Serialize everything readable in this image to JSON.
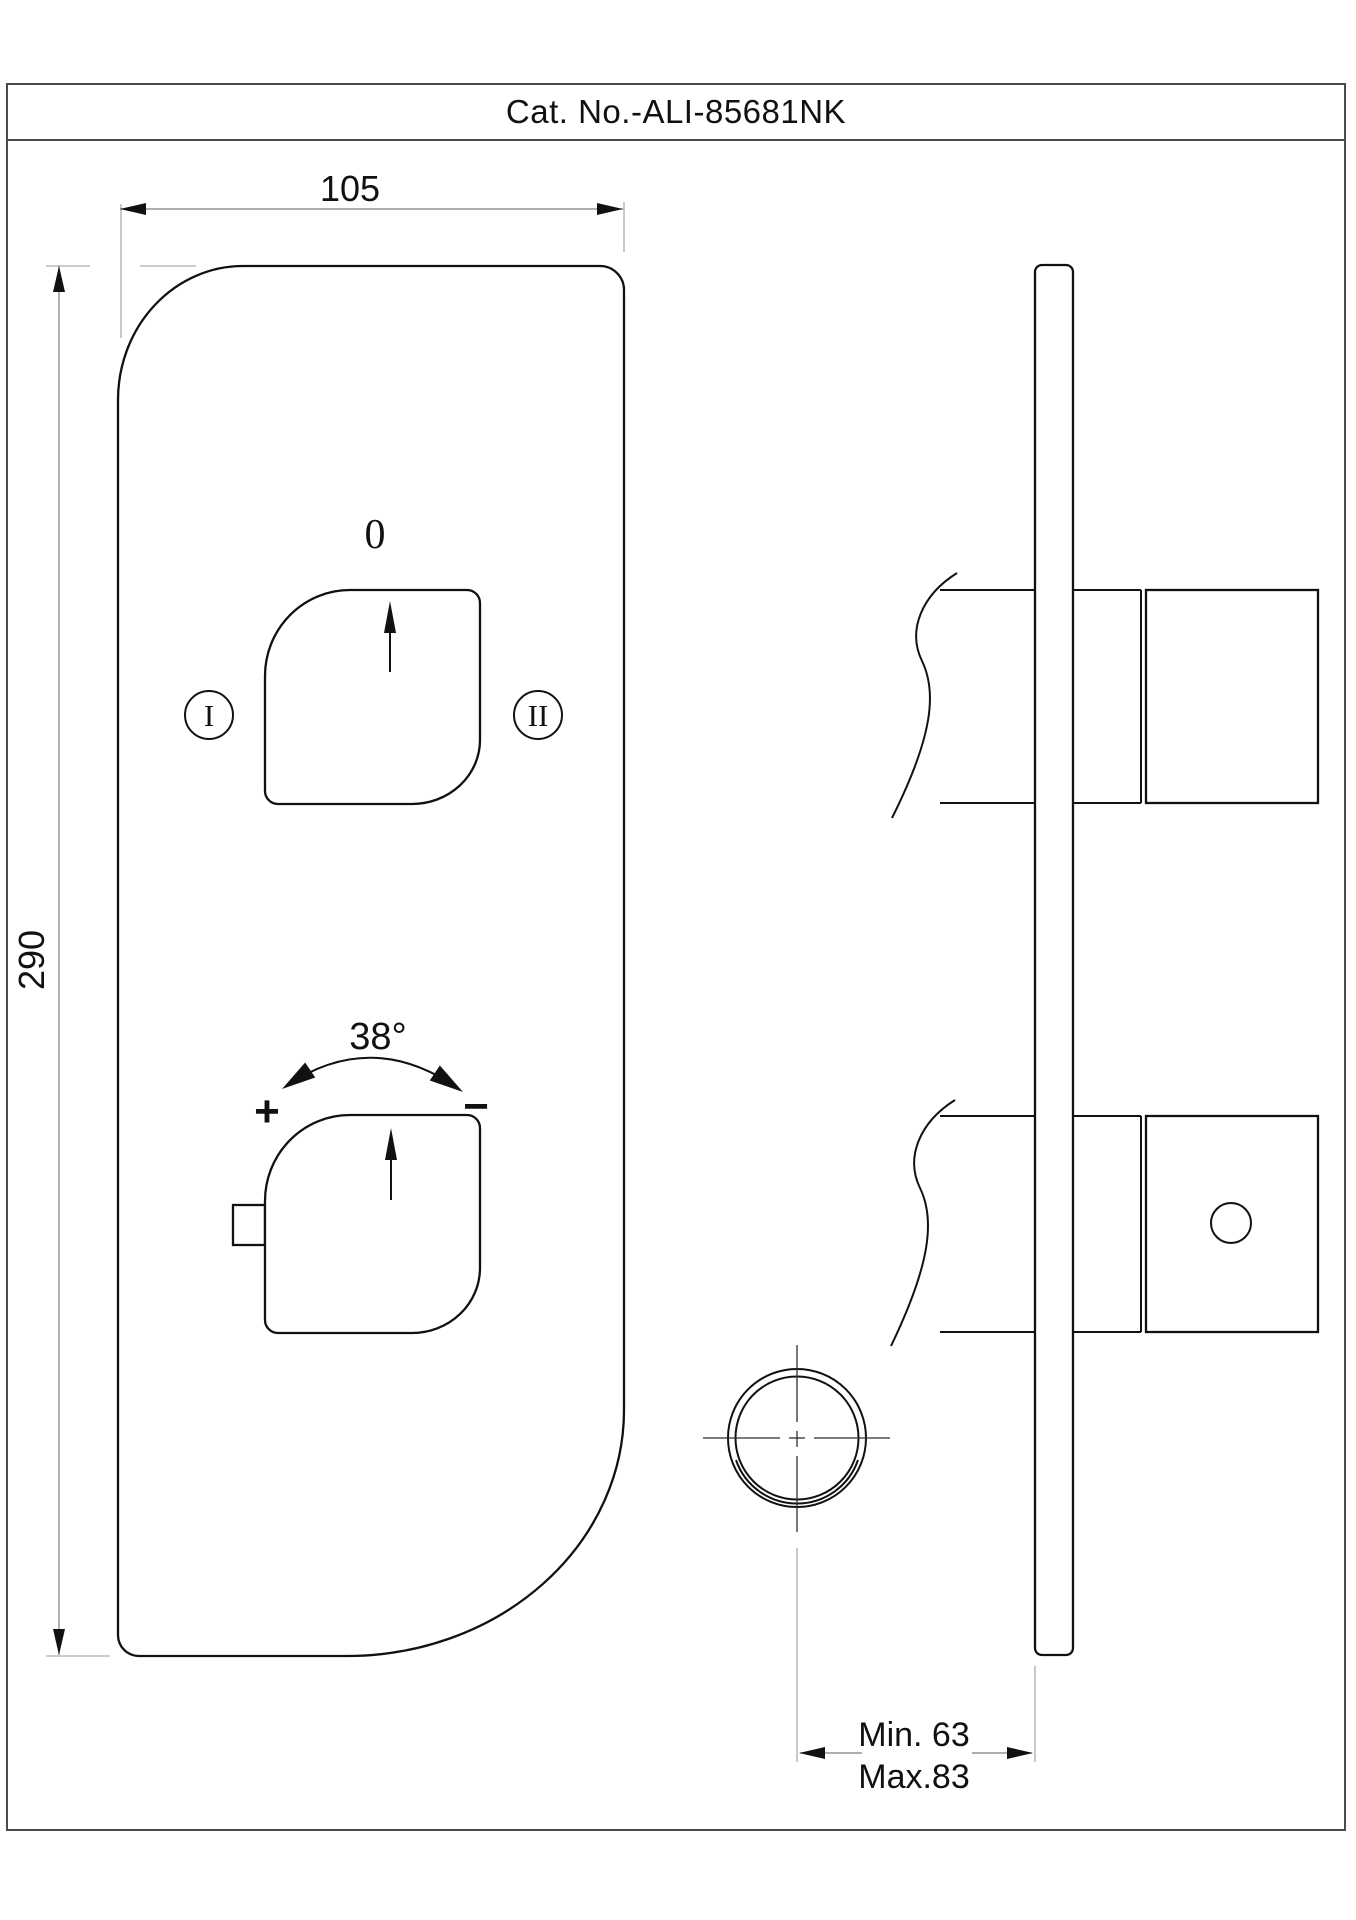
{
  "title_block": {
    "catalog_number": "Cat. No.-ALI-85681NK"
  },
  "front_view": {
    "width_dimension": "105",
    "height_dimension": "290",
    "diverter_knob": {
      "off_position_label": "0",
      "outlet_one_label": "I",
      "outlet_two_label": "II"
    },
    "temperature_knob": {
      "rotation_angle_label": "38°",
      "hotter_label": "+",
      "colder_label": "−"
    }
  },
  "side_view": {
    "wall_depth_min_label": "Min. 63",
    "wall_depth_max_label": "Max.83"
  },
  "colors": {
    "outline": "#111111",
    "dimension_line": "#7d7d7d",
    "extension_line": "#9a9a9a",
    "frame": "#4a4a4a",
    "background": "#ffffff"
  }
}
